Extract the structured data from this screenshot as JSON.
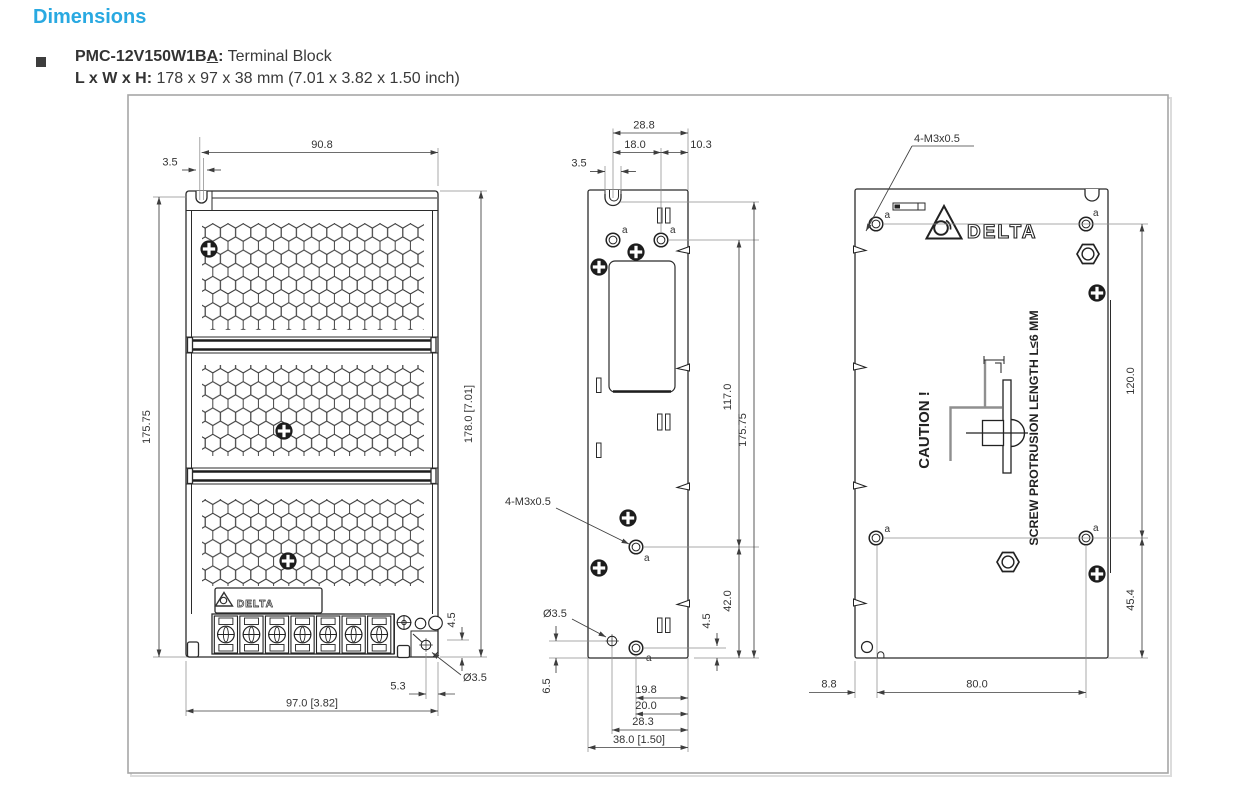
{
  "header": {
    "title": "Dimensions",
    "item": {
      "model_prefix": "PMC-12V150W1B",
      "model_underlined": "A",
      "model_suffix": ":",
      "model_desc": " Terminal Block",
      "size_label": "L x W x H: ",
      "size_value": "178 x 97 x 38 mm (7.01 x 3.82 x 1.50 inch)"
    }
  },
  "colors": {
    "accent": "#29A9E1",
    "line": "#2b2b2b",
    "frame_border": "#a6a6a6",
    "text": "#3a3a3a"
  },
  "front": {
    "logo_text": "DELTA",
    "dims": {
      "top_width": "90.8",
      "slot_width": "3.5",
      "height_left": "175.75",
      "height_right": "178.0 [7.01]",
      "corner_offset_v": "4.5",
      "hole_dia": "Ø3.5",
      "corner_offset_h": "5.3",
      "total_width": "97.0 [3.82]"
    }
  },
  "side": {
    "hole_note": "4-M3x0.5",
    "hole_dia": "Ø3.5",
    "marker": "a",
    "dims": {
      "top_total": "28.8",
      "top_left": "18.0",
      "top_right": "10.3",
      "slot_width": "3.5",
      "hole_span_v": "117.0",
      "height": "175.75",
      "hole_to_bottom": "42.0",
      "corner_offset_v": "4.5",
      "small_hole_bottom": "6.5",
      "hole_to_edge_a": "19.8",
      "hole_to_edge_b": "20.0",
      "small_hole_to_edge": "28.3",
      "total_width": "38.0 [1.50]"
    }
  },
  "back": {
    "logo_text": "DELTA",
    "hole_note": "4-M3x0.5",
    "marker": "a",
    "caution_title": "CAUTION !",
    "caution_note": "SCREW PROTRUSION LENGTH  L≤6 MM",
    "dims": {
      "hole_span_v": "120.0",
      "hole_to_bottom": "45.4",
      "edge_to_hole": "8.8",
      "hole_span_h": "80.0"
    }
  }
}
